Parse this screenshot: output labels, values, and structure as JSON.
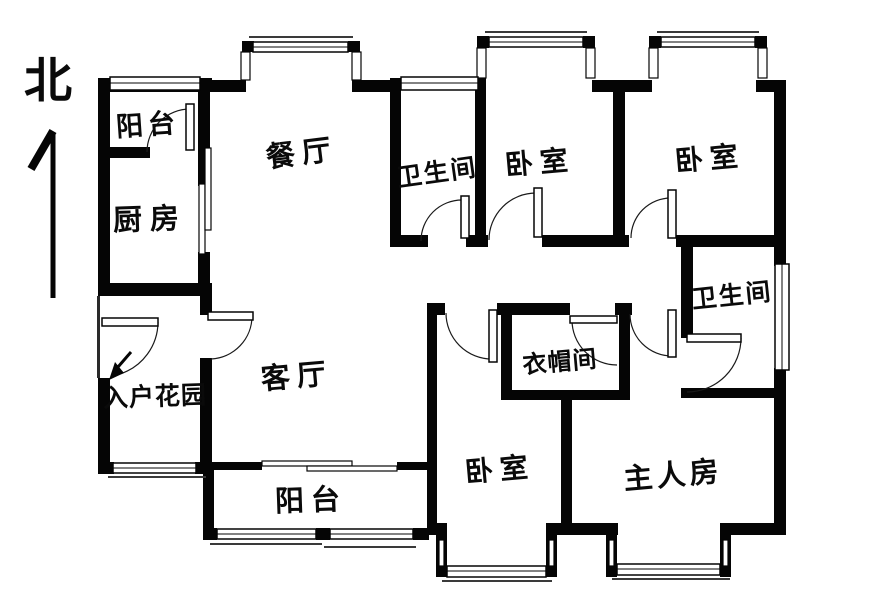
{
  "compass": {
    "north_label": "北"
  },
  "rooms": {
    "balcony_top": {
      "label": "阳台"
    },
    "kitchen": {
      "label": "厨房"
    },
    "dining_room": {
      "label": "餐厅"
    },
    "bathroom_top": {
      "label": "卫生间"
    },
    "bedroom_top_left": {
      "label": "卧室"
    },
    "bedroom_top_right": {
      "label": "卧室"
    },
    "bathroom_right": {
      "label": "卫生间"
    },
    "living_room": {
      "label": "客厅"
    },
    "entry_garden": {
      "label": "入户花园"
    },
    "cloakroom": {
      "label": "衣帽间"
    },
    "bedroom_bottom": {
      "label": "卧室"
    },
    "master_bedroom": {
      "label": "主人房"
    },
    "balcony_bottom": {
      "label": "阳台"
    }
  },
  "colors": {
    "wall": "#000000",
    "background": "#ffffff",
    "line": "#000000"
  }
}
